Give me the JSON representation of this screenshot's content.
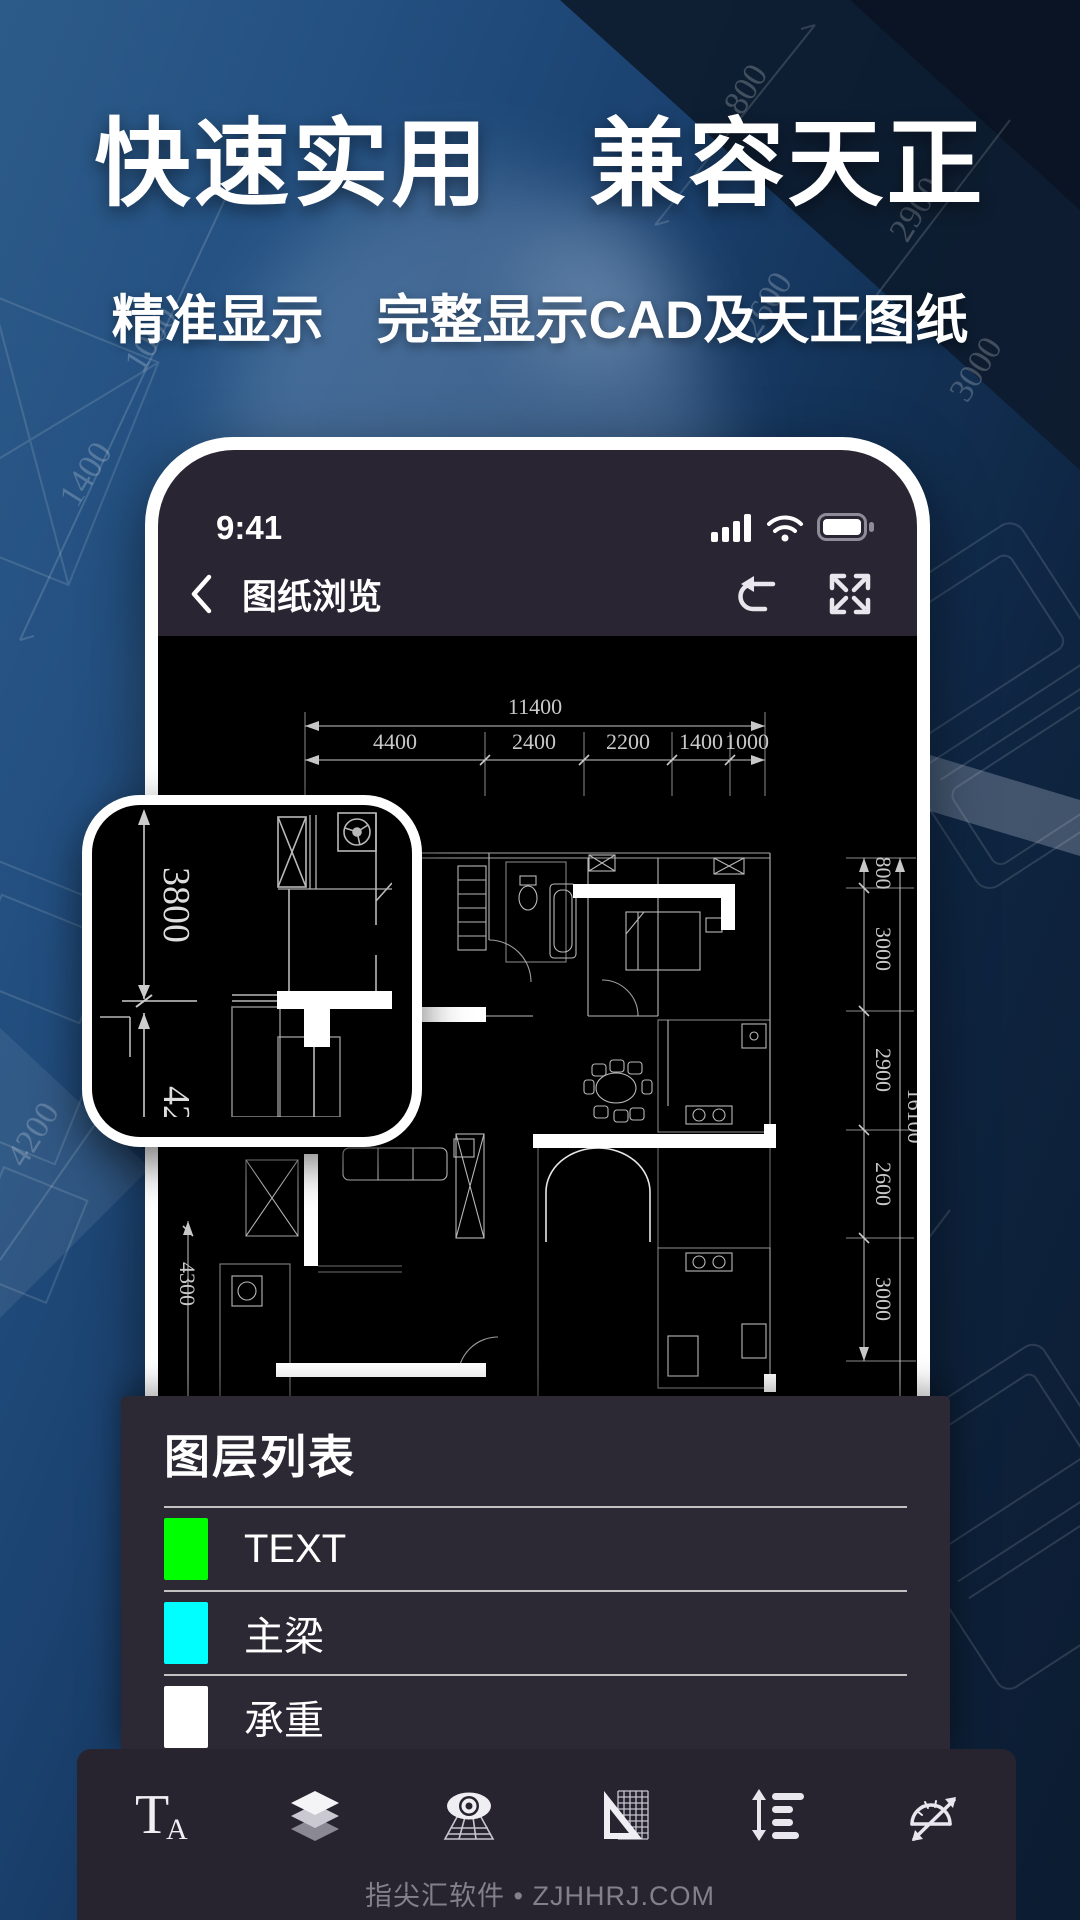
{
  "hero": {
    "title": "快速实用　兼容天正",
    "subtitle": "精准显示　完整显示CAD及天正图纸"
  },
  "phone": {
    "status": {
      "time": "9:41"
    },
    "nav": {
      "title": "图纸浏览"
    }
  },
  "drawing": {
    "dims_top_total": "11400",
    "dims_top": [
      "4400",
      "2400",
      "2200",
      "1400",
      "1000"
    ],
    "dims_right": [
      "800",
      "3000",
      "2900",
      "2600",
      "3000"
    ],
    "dims_right_total": "16100",
    "dims_left": "4300",
    "magnifier": {
      "dim_value": "3800",
      "dim_partial": "42"
    }
  },
  "background": {
    "faint_dims": [
      "1400",
      "1000",
      "800",
      "2900",
      "2600",
      "3000",
      "4200",
      "4400"
    ]
  },
  "layer_panel": {
    "title": "图层列表",
    "layers": [
      {
        "name": "TEXT",
        "color": "#00ff00"
      },
      {
        "name": "主梁",
        "color": "#00ffff"
      },
      {
        "name": "承重",
        "color": "#ffffff"
      }
    ]
  },
  "toolbar": {
    "text_icon": {
      "t": "T",
      "a": "A"
    },
    "buttons": [
      "text-style",
      "layers",
      "view-eye",
      "set-square-grid",
      "line-spacing",
      "protractor"
    ]
  },
  "footer": {
    "watermark": "指尖汇软件 • ZJHHRJ.COM"
  },
  "colors": {
    "layer_green": "#00ff00",
    "layer_cyan": "#00ffff",
    "layer_white": "#ffffff",
    "screen_bg": "#292532",
    "panel_bg": "#2c2935"
  }
}
